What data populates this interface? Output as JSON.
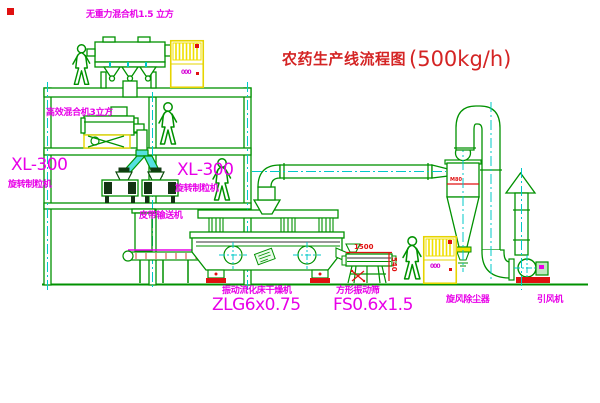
{
  "title": {
    "cn": "农药生产线流程图",
    "capacity": "(500kg/h)"
  },
  "labels": {
    "mixer_top": "无重力混合机1.5 立方",
    "mixer_high_eff": "高效混合机3立方",
    "granulator_left_model": "XL-300",
    "granulator_left_name": "旋转制粒机",
    "granulator_center_model": "XL-300",
    "granulator_center_name": "旋转制粒机",
    "belt_conveyor": "皮带输送机",
    "dryer_name": "振动流化床干燥机",
    "dryer_model": "ZLG6x0.75",
    "sieve_name": "方形振动筛",
    "sieve_model": "FS0.6x1.5",
    "cyclone_name": "旋风除尘器",
    "fan_name": "引风机"
  },
  "dimensions": {
    "sieve_length": "1500",
    "sieve_height": "540",
    "cyclone_mark": "M80"
  },
  "cabinets": {
    "panel_text_1": "000",
    "panel_text_2": "000"
  },
  "colors": {
    "line_green": "#009100",
    "center_cyan": "#00c8c8",
    "label_magenta": "#e800e8",
    "annotation_red": "#e01010",
    "cabinet_yellow": "#e6d400"
  }
}
